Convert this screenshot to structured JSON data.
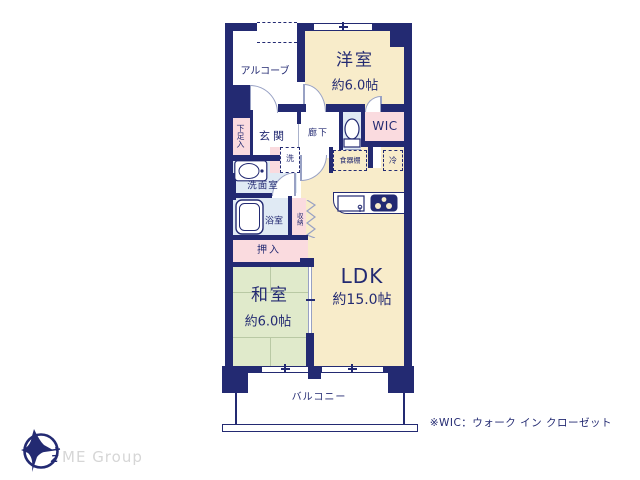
{
  "rooms": {
    "alcove": {
      "label": "アルコーブ"
    },
    "western": {
      "label": "洋室",
      "size": "約6.0帖"
    },
    "shoe": {
      "label": "下足入"
    },
    "entrance": {
      "label": "玄関"
    },
    "hallway": {
      "label": "廊下"
    },
    "wic": {
      "label": "WIC"
    },
    "cupboard": {
      "label": "食器棚"
    },
    "fridge": {
      "label": "冷"
    },
    "washer": {
      "label": "洗"
    },
    "washroom": {
      "label": "洗面室"
    },
    "bathroom": {
      "label": "浴室"
    },
    "storage": {
      "label": "収納"
    },
    "oshiire": {
      "label": "押入"
    },
    "japanese": {
      "label": "和室",
      "size": "約6.0帖"
    },
    "ldk": {
      "label": "LDK",
      "size": "約15.0帖"
    },
    "balcony": {
      "label": "バルコニー"
    }
  },
  "footer": {
    "brand": "ME Group",
    "note": "※WIC：ウォーク イン クローゼット"
  },
  "colors": {
    "wall_navy": "#232a72",
    "wood_cream": "#f8ecca",
    "tatami_green": "#e0eacb",
    "closet_pink": "#fadbdf",
    "wet_blue": "#e0eaf4"
  }
}
